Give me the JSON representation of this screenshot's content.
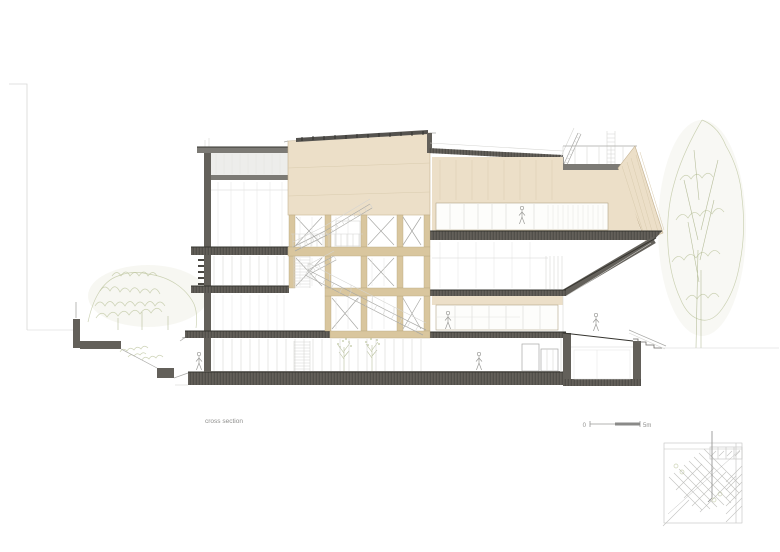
{
  "drawing": {
    "type": "architectural cross section",
    "caption": "cross section",
    "scale_bar": {
      "zero_label": "0",
      "end_label": "5m"
    }
  },
  "colors": {
    "background": "#ffffff",
    "beige_wall": "#ecdfc8",
    "wood_structure": "#d9c69e",
    "slab_gray": "#63605a",
    "slab_edge": "#35342f",
    "roof_gray": "#7c7a75",
    "line_gray": "#a8a8a5",
    "glazing_gray": "#d4d4d1",
    "text_gray": "#8f8f8d",
    "green_foliage": "#bcc49e",
    "keyplan_gray": "#c2c2c0"
  }
}
